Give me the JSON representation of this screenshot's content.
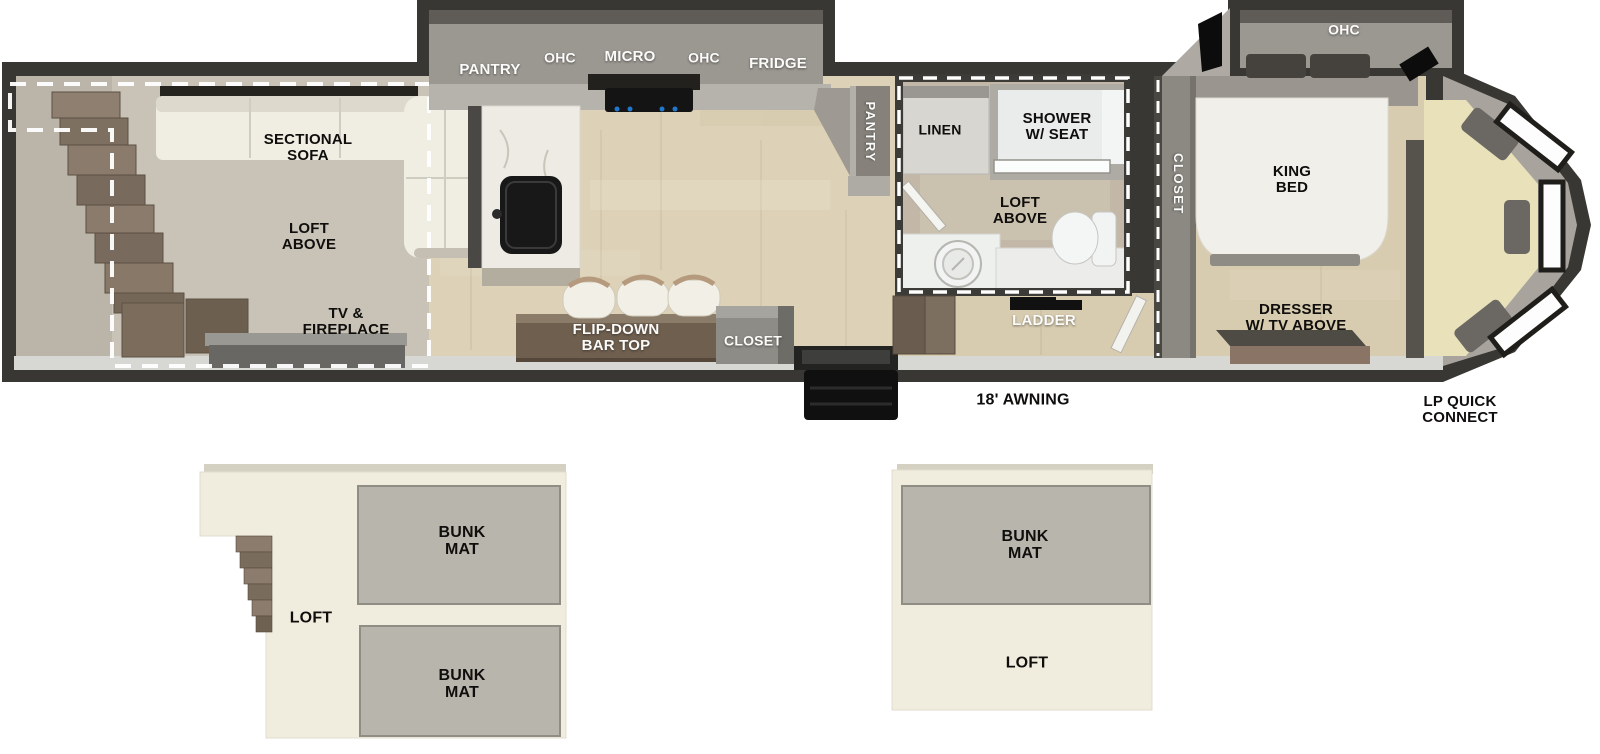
{
  "floorplan": {
    "living": {
      "sectional_sofa": "SECTIONAL\nSOFA",
      "loft_above": "LOFT\nABOVE",
      "tv_fireplace": "TV &\nFIREPLACE"
    },
    "kitchen": {
      "pantry_overhead": "PANTRY",
      "ohc_left": "OHC",
      "micro": "MICRO",
      "ohc_right": "OHC",
      "fridge": "FRIDGE",
      "flip_down_bar_top": "FLIP-DOWN\nBAR TOP",
      "closet": "CLOSET",
      "pantry_tall": "PANTRY"
    },
    "bathroom": {
      "linen": "LINEN",
      "shower_w_seat": "SHOWER\nW/ SEAT",
      "loft_above": "LOFT\nABOVE"
    },
    "hall": {
      "ladder": "LADDER"
    },
    "bedroom": {
      "ohc": "OHC",
      "closet": "CLOSET",
      "king_bed": "KING\nBED",
      "dresser": "DRESSER\nW/ TV ABOVE"
    },
    "exterior": {
      "awning": "18' AWNING",
      "lp_quick_connect": "LP QUICK\nCONNECT"
    }
  },
  "lofts": {
    "left": {
      "bunk_mat_top": "BUNK\nMAT",
      "bunk_mat_bottom": "BUNK\nMAT",
      "loft": "LOFT"
    },
    "right": {
      "bunk_mat": "BUNK\nMAT",
      "loft": "LOFT"
    }
  },
  "colors": {
    "wall_dark": "#393733",
    "cabinet_gray": "#9b9791",
    "wood_floor": "#ddd2b7",
    "living_floor": "#c9c3b7",
    "bath_floor": "#c3b8a8",
    "cream_seat": "#e9e1ba",
    "loft_cream": "#f1edde",
    "bunk_mat_gray": "#b8b6ac",
    "bar_brown": "#6f5f4e",
    "stair_brown": "#8b7c6d",
    "accent_white_dash": "#ffffff"
  }
}
